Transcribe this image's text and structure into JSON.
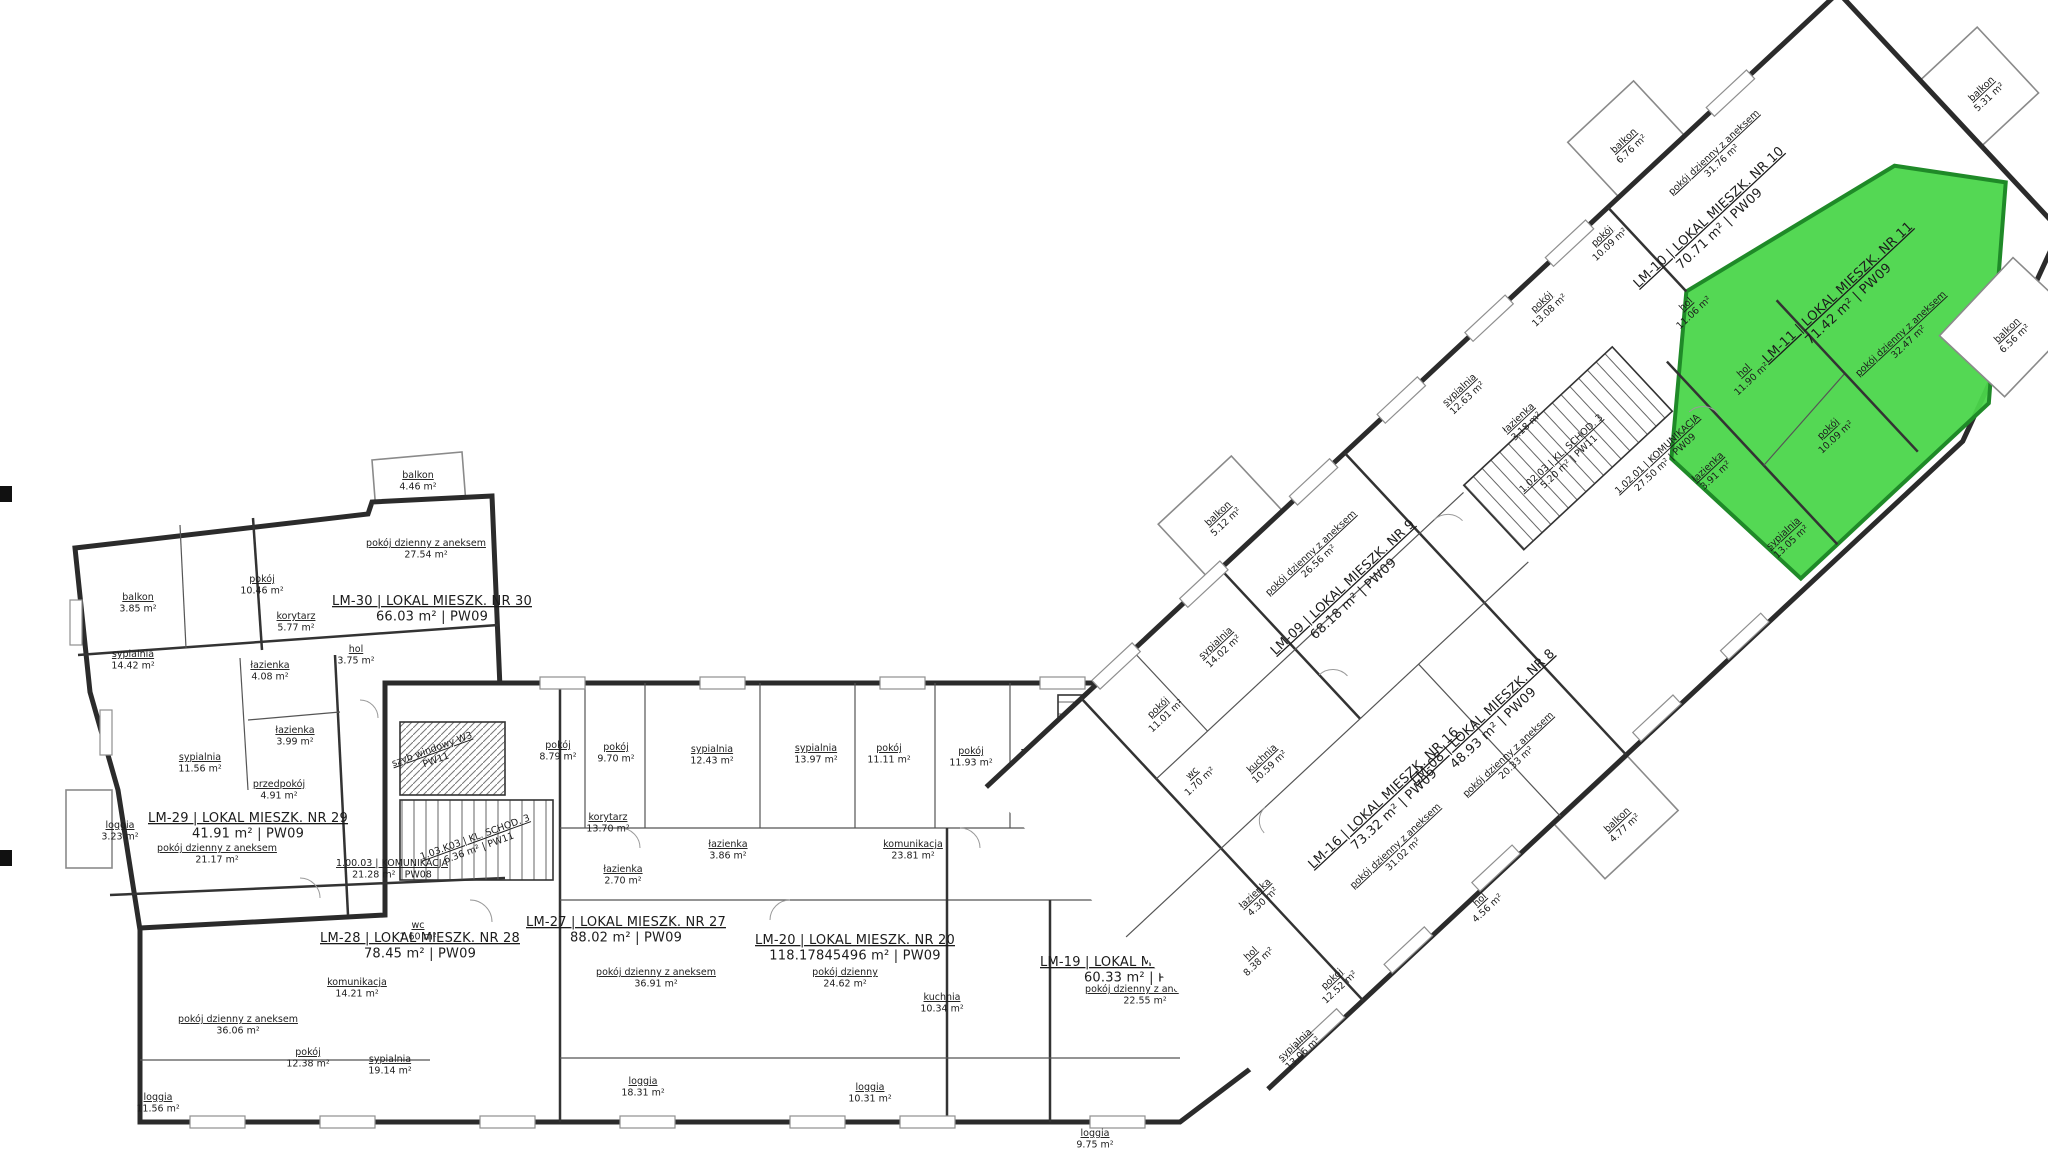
{
  "drawing": {
    "kind": "floor-plan",
    "language": "pl",
    "sheet_codes": [
      "PW08",
      "PW09",
      "PW11"
    ]
  },
  "highlight": {
    "unit": "LM-11",
    "color": "#4bd64b",
    "edge_color": "#1f8a28"
  },
  "labels": [
    {
      "layer": "plan",
      "cls": "unit",
      "name": "unit-label-lm30",
      "x": 432,
      "y": 605,
      "lines": [
        "LM-30 | LOKAL MIESZK. NR 30",
        "66.03 m² | PW09"
      ]
    },
    {
      "layer": "plan",
      "cls": "unit",
      "name": "unit-label-lm29",
      "x": 248,
      "y": 822,
      "lines": [
        "LM-29 | LOKAL MIESZK. NR 29",
        "41.91 m² | PW09"
      ]
    },
    {
      "layer": "plan",
      "cls": "unit",
      "name": "unit-label-lm28",
      "x": 420,
      "y": 942,
      "lines": [
        "LM-28 | LOKAL MIESZK. NR 28",
        "78.45 m² | PW09"
      ]
    },
    {
      "layer": "plan",
      "cls": "unit",
      "name": "unit-label-lm27",
      "x": 626,
      "y": 926,
      "lines": [
        "LM-27 | LOKAL MIESZK. NR 27",
        "88.02 m² | PW09"
      ]
    },
    {
      "layer": "plan",
      "cls": "unit",
      "name": "unit-label-lm20",
      "x": 855,
      "y": 944,
      "lines": [
        "LM-20 | LOKAL MIESZK. NR 20",
        "118.17845496 m² | PW09"
      ]
    },
    {
      "layer": "plan",
      "cls": "unit",
      "name": "unit-label-lm19",
      "x": 1140,
      "y": 966,
      "lines": [
        "LM-19 | LOKAL MIESZK. NR 19",
        "60.33 m² | PW09"
      ]
    },
    {
      "layer": "plan",
      "cls": "core",
      "name": "core-label-komunikacja-1-00-03",
      "x": 392,
      "y": 866,
      "lines": [
        "1.00.03 | KOMUNIKACJA",
        "21.28 m² | PW08"
      ]
    },
    {
      "layer": "plan",
      "cls": "core",
      "name": "core-label-kl-schod-3-left",
      "x": 476,
      "y": 840,
      "rot": -20,
      "lines": [
        "1.03.K03 | KL. SCHOD. 3",
        "6.36 m² | PW11"
      ]
    },
    {
      "layer": "plan",
      "cls": "core",
      "name": "core-label-szyb-windowy",
      "x": 433,
      "y": 752,
      "rot": -20,
      "lines": [
        "szyb windowy W3",
        "PW11"
      ]
    },
    {
      "layer": "plan",
      "cls": "core",
      "name": "core-label-kl-schod-2",
      "x": 1078,
      "y": 756,
      "lines": [
        "1.02.K02 | KL. SCHOD. 2",
        "5.20 m² | PW11"
      ]
    },
    {
      "layer": "plan",
      "cls": "core",
      "name": "core-label-komunikacja-1-02-02",
      "x": 1108,
      "y": 852,
      "lines": [
        "1.02.02 | KOMUNIKACJA",
        "15.98 m² | PW09"
      ]
    },
    {
      "layer": "plan",
      "cls": "room",
      "name": "room-balkon-385",
      "x": 138,
      "y": 600,
      "lines": [
        "balkon",
        "3.85 m²"
      ]
    },
    {
      "layer": "plan",
      "cls": "room",
      "name": "room-pokoj-1046",
      "x": 262,
      "y": 582,
      "lines": [
        "pokój",
        "10.46 m²"
      ]
    },
    {
      "layer": "plan",
      "cls": "room",
      "name": "room-balkon-446",
      "x": 418,
      "y": 478,
      "lines": [
        "balkon",
        "4.46 m²"
      ]
    },
    {
      "layer": "plan",
      "cls": "room",
      "name": "room-pdza-2754",
      "x": 426,
      "y": 546,
      "lines": [
        "pokój dzienny z aneksem",
        "27.54 m²"
      ]
    },
    {
      "layer": "plan",
      "cls": "room",
      "name": "room-korytarz-577",
      "x": 296,
      "y": 619,
      "lines": [
        "korytarz",
        "5.77 m²"
      ]
    },
    {
      "layer": "plan",
      "cls": "room",
      "name": "room-hol-375",
      "x": 356,
      "y": 652,
      "lines": [
        "hol",
        "3.75 m²"
      ]
    },
    {
      "layer": "plan",
      "cls": "room",
      "name": "room-sypialnia-1442",
      "x": 133,
      "y": 657,
      "lines": [
        "sypialnia",
        "14.42 m²"
      ]
    },
    {
      "layer": "plan",
      "cls": "room",
      "name": "room-lazienka-408",
      "x": 270,
      "y": 668,
      "lines": [
        "łazienka",
        "4.08 m²"
      ]
    },
    {
      "layer": "plan",
      "cls": "room",
      "name": "room-lazienka-399",
      "x": 295,
      "y": 733,
      "lines": [
        "łazienka",
        "3.99 m²"
      ]
    },
    {
      "layer": "plan",
      "cls": "room",
      "name": "room-sypialnia-1156",
      "x": 200,
      "y": 760,
      "lines": [
        "sypialnia",
        "11.56 m²"
      ]
    },
    {
      "layer": "plan",
      "cls": "room",
      "name": "room-przedpokoj-491",
      "x": 279,
      "y": 787,
      "lines": [
        "przedpokój",
        "4.91 m²"
      ]
    },
    {
      "layer": "plan",
      "cls": "room",
      "name": "room-loggia-323",
      "x": 120,
      "y": 828,
      "lines": [
        "loggia",
        "3.23 m²"
      ]
    },
    {
      "layer": "plan",
      "cls": "room",
      "name": "room-pdza-2117",
      "x": 217,
      "y": 851,
      "lines": [
        "pokój dzienny z aneksem",
        "21.17 m²"
      ]
    },
    {
      "layer": "plan",
      "cls": "room",
      "name": "room-wc-160",
      "x": 418,
      "y": 928,
      "lines": [
        "wc",
        "1.60 m²"
      ]
    },
    {
      "layer": "plan",
      "cls": "room",
      "name": "room-pokoj-879",
      "x": 558,
      "y": 748,
      "lines": [
        "pokój",
        "8.79 m²"
      ]
    },
    {
      "layer": "plan",
      "cls": "room",
      "name": "room-pokoj-970",
      "x": 616,
      "y": 750,
      "lines": [
        "pokój",
        "9.70 m²"
      ]
    },
    {
      "layer": "plan",
      "cls": "room",
      "name": "room-sypialnia-1243",
      "x": 712,
      "y": 752,
      "lines": [
        "sypialnia",
        "12.43 m²"
      ]
    },
    {
      "layer": "plan",
      "cls": "room",
      "name": "room-sypialnia-1397",
      "x": 816,
      "y": 751,
      "lines": [
        "sypialnia",
        "13.97 m²"
      ]
    },
    {
      "layer": "plan",
      "cls": "room",
      "name": "room-pokoj-1111",
      "x": 889,
      "y": 751,
      "lines": [
        "pokój",
        "11.11 m²"
      ]
    },
    {
      "layer": "plan",
      "cls": "room",
      "name": "room-pokoj-1193",
      "x": 971,
      "y": 754,
      "lines": [
        "pokój",
        "11.93 m²"
      ]
    },
    {
      "layer": "plan",
      "cls": "room",
      "name": "room-korytarz-1370",
      "x": 608,
      "y": 820,
      "lines": [
        "korytarz",
        "13.70 m²"
      ]
    },
    {
      "layer": "plan",
      "cls": "room",
      "name": "room-lazienka-270",
      "x": 623,
      "y": 872,
      "lines": [
        "łazienka",
        "2.70 m²"
      ]
    },
    {
      "layer": "plan",
      "cls": "room",
      "name": "room-lazienka-386",
      "x": 728,
      "y": 847,
      "lines": [
        "łazienka",
        "3.86 m²"
      ]
    },
    {
      "layer": "plan",
      "cls": "room",
      "name": "room-komunikacja-2381",
      "x": 913,
      "y": 847,
      "lines": [
        "komunikacja",
        "23.81 m²"
      ]
    },
    {
      "layer": "plan",
      "cls": "room",
      "name": "room-pdza-3691",
      "x": 656,
      "y": 975,
      "lines": [
        "pokój dzienny z aneksem",
        "36.91 m²"
      ]
    },
    {
      "layer": "plan",
      "cls": "room",
      "name": "room-loggia-1831",
      "x": 643,
      "y": 1084,
      "lines": [
        "loggia",
        "18.31 m²"
      ]
    },
    {
      "layer": "plan",
      "cls": "room",
      "name": "room-pokoj-dzienny-2462",
      "x": 845,
      "y": 975,
      "lines": [
        "pokój dzienny",
        "24.62 m²"
      ]
    },
    {
      "layer": "plan",
      "cls": "room",
      "name": "room-kuchnia-1034",
      "x": 942,
      "y": 1000,
      "lines": [
        "kuchnia",
        "10.34 m²"
      ]
    },
    {
      "layer": "plan",
      "cls": "room",
      "name": "room-loggia-1031",
      "x": 870,
      "y": 1090,
      "lines": [
        "loggia",
        "10.31 m²"
      ]
    },
    {
      "layer": "plan",
      "cls": "room",
      "name": "room-pdza-3606",
      "x": 238,
      "y": 1022,
      "lines": [
        "pokój dzienny z aneksem",
        "36.06 m²"
      ]
    },
    {
      "layer": "plan",
      "cls": "room",
      "name": "room-pokoj-1238",
      "x": 308,
      "y": 1055,
      "lines": [
        "pokój",
        "12.38 m²"
      ]
    },
    {
      "layer": "plan",
      "cls": "room",
      "name": "room-sypialnia-1914",
      "x": 390,
      "y": 1062,
      "lines": [
        "sypialnia",
        "19.14 m²"
      ]
    },
    {
      "layer": "plan",
      "cls": "room",
      "name": "room-komunikacja-1421",
      "x": 357,
      "y": 985,
      "lines": [
        "komunikacja",
        "14.21 m²"
      ]
    },
    {
      "layer": "plan",
      "cls": "room",
      "name": "room-loggia-1156",
      "x": 158,
      "y": 1100,
      "lines": [
        "loggia",
        "11.56 m²"
      ]
    },
    {
      "layer": "plan",
      "cls": "room",
      "name": "room-pdza-2255",
      "x": 1145,
      "y": 992,
      "lines": [
        "pokój dzienny z aneksem",
        "22.55 m²"
      ]
    },
    {
      "layer": "plan",
      "cls": "room",
      "name": "room-loggia-975",
      "x": 1095,
      "y": 1136,
      "lines": [
        "loggia",
        "9.75 m²"
      ]
    },
    {
      "layer": "wing",
      "cls": "unit",
      "name": "unit-label-lm16",
      "x": 213,
      "y": 118,
      "lines": [
        "LM-16 | LOKAL MIESZK. NR 16",
        "73.32 m² | PW09"
      ]
    },
    {
      "layer": "wing",
      "cls": "unit",
      "name": "unit-label-lm09",
      "x": 327,
      "y": -64,
      "lines": [
        "LM-09 | LOKAL MIESZK. NR 9",
        "68.18 m² | PW09"
      ]
    },
    {
      "layer": "wing",
      "cls": "unit",
      "name": "unit-label-lm08",
      "x": 341,
      "y": 126,
      "lines": [
        "LM-08 | LOKAL MIESZK. NR 8",
        "48.93 m² | PW09"
      ]
    },
    {
      "layer": "wing",
      "cls": "unit",
      "name": "unit-label-lm10",
      "x": 847,
      "y": -85,
      "lines": [
        "LM-10 | LOKAL MIESZK. NR 10",
        "70.71 m² | PW09"
      ]
    },
    {
      "layer": "wing",
      "cls": "unit",
      "name": "unit-label-lm11",
      "x": 890,
      "y": 58,
      "interactable": true,
      "lines": [
        "LM-11 | LOKAL MIESZK. NR 11",
        "71.42 m² | PW09"
      ]
    },
    {
      "layer": "wing",
      "cls": "core",
      "name": "core-label-kl-schod-3-wing",
      "x": 578,
      "y": -14,
      "lines": [
        "1.02.03 | KL. SCHOD. 3",
        "5.20 m² | PW11"
      ]
    },
    {
      "layer": "wing",
      "cls": "core",
      "name": "core-label-komunikacja-1-02-01",
      "x": 648,
      "y": 52,
      "lines": [
        "1.02.01 | KOMUNIKACJA",
        "27.50 m² | PW09"
      ]
    },
    {
      "layer": "wing",
      "cls": "room",
      "name": "room-balkon-512",
      "x": 286,
      "y": -204,
      "lines": [
        "balkon",
        "5.12 m²"
      ]
    },
    {
      "layer": "wing",
      "cls": "room",
      "name": "room-pdza-2656",
      "x": 327,
      "y": -112,
      "lines": [
        "pokój dzienny z aneksem",
        "26.56 m²"
      ]
    },
    {
      "layer": "wing",
      "cls": "room",
      "name": "room-sypialnia-1402",
      "x": 196,
      "y": -111,
      "lines": [
        "sypialnia",
        "14.02 m²"
      ]
    },
    {
      "layer": "wing",
      "cls": "room",
      "name": "room-pokoj-1101",
      "x": 110,
      "y": -103,
      "lines": [
        "pokój",
        "11.01 m²"
      ]
    },
    {
      "layer": "wing",
      "cls": "room",
      "name": "room-lazienka-318",
      "x": 571,
      "y": -69,
      "lines": [
        "łazienka",
        "3.18 m²"
      ]
    },
    {
      "layer": "wing",
      "cls": "room",
      "name": "room-sypialnia-1263",
      "x": 547,
      "y": -130,
      "lines": [
        "sypialnia",
        "12.63 m²"
      ]
    },
    {
      "layer": "wing",
      "cls": "room",
      "name": "room-pokoj-1308",
      "x": 667,
      "y": -138,
      "lines": [
        "pokój",
        "13.08 m²"
      ]
    },
    {
      "layer": "wing",
      "cls": "room",
      "name": "room-hol-1106",
      "x": 771,
      "y": -38,
      "lines": [
        "hol",
        "11.06 m²"
      ]
    },
    {
      "layer": "wing",
      "cls": "room",
      "name": "room-pokoj-1009-lm10",
      "x": 756,
      "y": -145,
      "lines": [
        "pokój",
        "10.09 m²"
      ]
    },
    {
      "layer": "wing",
      "cls": "room",
      "name": "room-balkon-676",
      "x": 837,
      "y": -200,
      "lines": [
        "balkon",
        "6.76 m²"
      ]
    },
    {
      "layer": "wing",
      "cls": "room",
      "name": "room-pdza-3176",
      "x": 895,
      "y": -130,
      "lines": [
        "pokój dzienny z aneksem",
        "31.76 m²"
      ]
    },
    {
      "layer": "wing",
      "cls": "room",
      "name": "room-balkon-531",
      "x": 1134,
      "y": 6,
      "lines": [
        "balkon",
        "5.31 m²"
      ]
    },
    {
      "layer": "wing",
      "cls": "room",
      "name": "room-kuchnia-1059",
      "x": 151,
      "y": 5,
      "lines": [
        "kuchnia",
        "10.59 m²"
      ]
    },
    {
      "layer": "wing",
      "cls": "room",
      "name": "room-wc-170",
      "x": 90,
      "y": -32,
      "lines": [
        "wc",
        "1.70 m²"
      ]
    },
    {
      "layer": "wing",
      "cls": "room",
      "name": "room-lazienka-430",
      "x": 54,
      "y": 99,
      "lines": [
        "łazienka",
        "4.30 m²"
      ]
    },
    {
      "layer": "wing",
      "cls": "room",
      "name": "room-hol-838",
      "x": 10,
      "y": 140,
      "lines": [
        "hol",
        "8.38 m²"
      ]
    },
    {
      "layer": "wing",
      "cls": "room",
      "name": "room-pokoj-1252",
      "x": 52,
      "y": 214,
      "lines": [
        "pokój",
        "12.52 m²"
      ]
    },
    {
      "layer": "wing",
      "cls": "room",
      "name": "room-sypialnia-1306",
      "x": -20,
      "y": 237,
      "lines": [
        "sypialnia",
        "13.06 m²"
      ]
    },
    {
      "layer": "wing",
      "cls": "room",
      "name": "room-pdza-3102",
      "x": 189,
      "y": 160,
      "lines": [
        "pokój dzienny z aneksem",
        "31.02 m²"
      ]
    },
    {
      "layer": "wing",
      "cls": "room",
      "name": "room-pdza-2033",
      "x": 334,
      "y": 170,
      "lines": [
        "pokój dzienny z aneksem",
        "20.33 m²"
      ]
    },
    {
      "layer": "wing",
      "cls": "room",
      "name": "room-hol-456",
      "x": 214,
      "y": 257,
      "lines": [
        "hol",
        "4.56 m²"
      ]
    },
    {
      "layer": "wing",
      "cls": "room",
      "name": "room-balkon-477",
      "x": 369,
      "y": 292,
      "lines": [
        "balkon",
        "4.77 m²"
      ]
    },
    {
      "layer": "wing",
      "cls": "room",
      "name": "room-lazienka-391",
      "x": 676,
      "y": 96,
      "lines": [
        "łazienka",
        "3.91 m²"
      ]
    },
    {
      "layer": "wing",
      "cls": "room",
      "name": "room-hol-1190",
      "x": 768,
      "y": 50,
      "lines": [
        "hol",
        "11.90 m²"
      ]
    },
    {
      "layer": "wing",
      "cls": "room",
      "name": "room-pokoj-1009-lm11",
      "x": 790,
      "y": 150,
      "lines": [
        "pokój",
        "10.09 m²"
      ]
    },
    {
      "layer": "wing",
      "cls": "room",
      "name": "room-sypialnia-1305",
      "x": 686,
      "y": 196,
      "lines": [
        "sypialnia",
        "13.05 m²"
      ]
    },
    {
      "layer": "wing",
      "cls": "room",
      "name": "room-pdza-3247",
      "x": 908,
      "y": 130,
      "lines": [
        "pokój dzienny z aneksem",
        "32.47 m²"
      ]
    },
    {
      "layer": "wing",
      "cls": "room",
      "name": "room-balkon-656",
      "x": 988,
      "y": 200,
      "lines": [
        "balkon",
        "6.56 m²"
      ]
    }
  ]
}
